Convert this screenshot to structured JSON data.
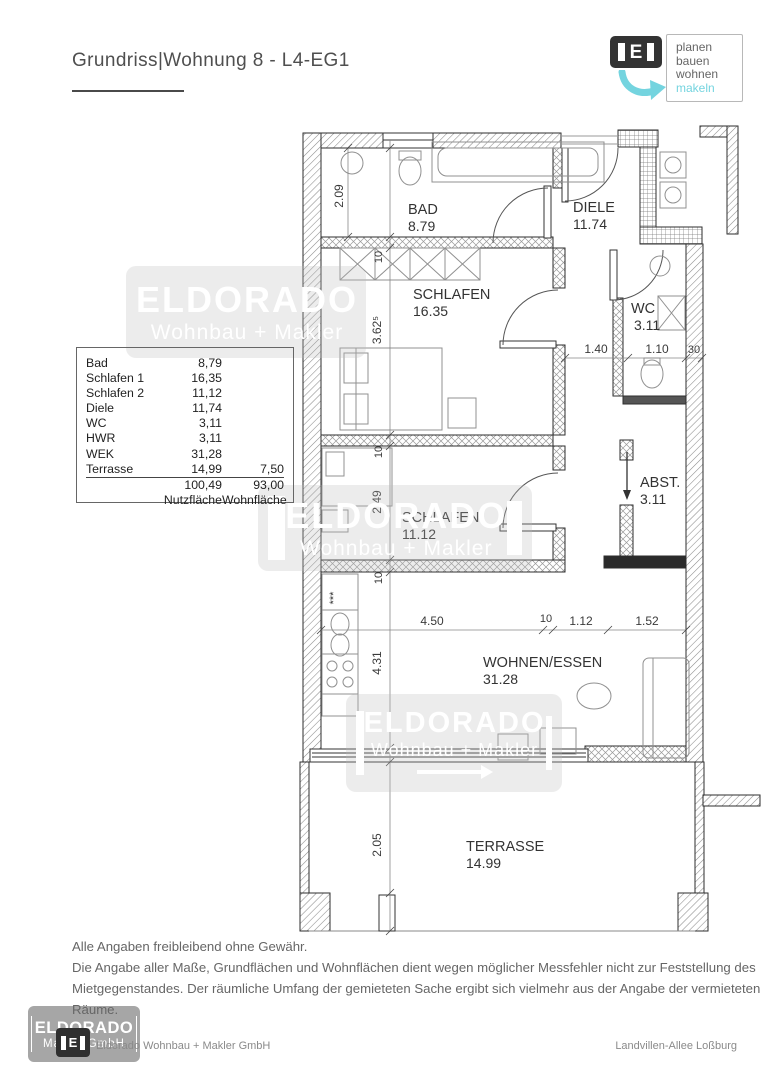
{
  "header": {
    "title": "Grundriss|Wohnung 8 - L4-EG1",
    "logo": {
      "letter": "E",
      "tagline_lines": [
        "planen",
        "bauen",
        "wohnen",
        "makeln"
      ],
      "accent_color": "#74d4df"
    }
  },
  "area_table": {
    "rows": [
      {
        "label": "Bad",
        "nutzflaeche": "8,79",
        "wohnflaeche": ""
      },
      {
        "label": "Schlafen 1",
        "nutzflaeche": "16,35",
        "wohnflaeche": ""
      },
      {
        "label": "Schlafen 2",
        "nutzflaeche": "11,12",
        "wohnflaeche": ""
      },
      {
        "label": "Diele",
        "nutzflaeche": "11,74",
        "wohnflaeche": ""
      },
      {
        "label": "WC",
        "nutzflaeche": "3,11",
        "wohnflaeche": ""
      },
      {
        "label": "HWR",
        "nutzflaeche": "3,11",
        "wohnflaeche": ""
      },
      {
        "label": "WEK",
        "nutzflaeche": "31,28",
        "wohnflaeche": ""
      },
      {
        "label": "Terrasse",
        "nutzflaeche": "14,99",
        "wohnflaeche": "7,50"
      }
    ],
    "totals": {
      "nutzflaeche": "100,49",
      "wohnflaeche": "93,00"
    },
    "column_footers": {
      "nutzflaeche": "Nutzfläche",
      "wohnflaeche": "Wohnfläche"
    }
  },
  "plan": {
    "rooms": [
      {
        "name": "BAD",
        "area": "8.79"
      },
      {
        "name": "DIELE",
        "area": "11.74"
      },
      {
        "name": "SCHLAFEN",
        "area": "16.35"
      },
      {
        "name": "WC",
        "area": "3.11"
      },
      {
        "name": "SCHLAFEN",
        "area": "11.12"
      },
      {
        "name": "ABST.",
        "area": "3.11"
      },
      {
        "name": "WOHNEN/ESSEN",
        "area": "31.28"
      },
      {
        "name": "TERRASSE",
        "area": "14.99"
      }
    ],
    "dims": {
      "bad_height": "2.09",
      "wall_a": "10",
      "schlafen1_height": "3.62⁵",
      "wall_b": "10",
      "schlafen2_height": "2.49",
      "wall_c": "10",
      "wohnen_height": "4.31",
      "terrasse_height": "2.05",
      "flur_width": "1.40",
      "wc_width": "1.10",
      "wall_right": "30",
      "wohnen_width": "4.50",
      "wall_d": "10",
      "abst_width": "1.12",
      "abst_width2": "1.52"
    },
    "symbols": {
      "freezer": "***"
    }
  },
  "watermarks": {
    "line1": "ELDORADO",
    "line2": "Wohnbau + Makler",
    "footer_line2": "Makler GmbH"
  },
  "disclaimer": {
    "line1": "Alle Angaben freibleibend ohne Gewähr.",
    "line2": "Die Angabe aller Maße, Grundflächen und Wohnflächen dient wegen möglicher Messfehler nicht zur Feststellung des",
    "line3": "Mietgegenstandes. Der räumliche Umfang der gemieteten Sache ergibt sich vielmehr aus der Angabe der vermieteten",
    "line4": "Räume."
  },
  "page_footer": {
    "company": "Eldorado Wohnbau + Makler GmbH",
    "location": "Landvillen-Allee Loßburg"
  }
}
